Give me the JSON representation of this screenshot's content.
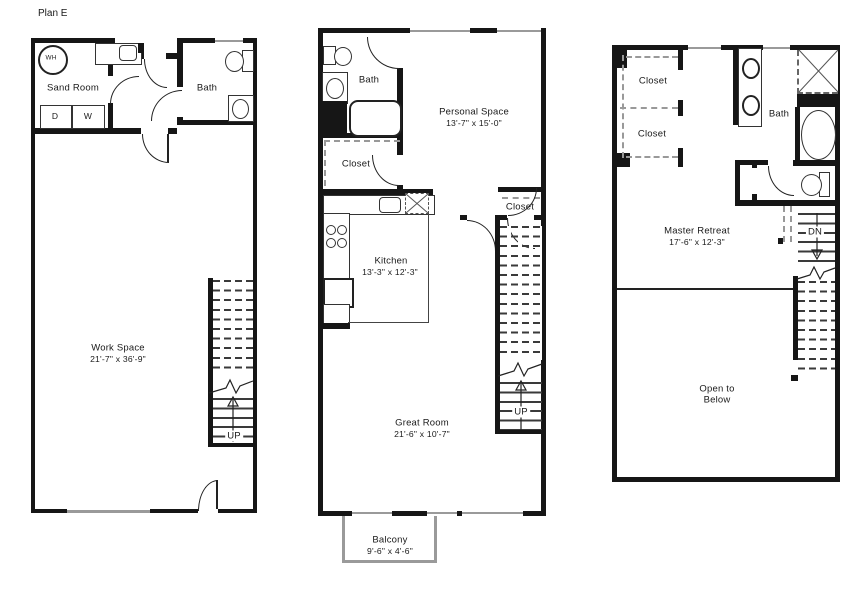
{
  "page_title": "Plan E",
  "colors": {
    "wall": "#161616",
    "dash": "#999999",
    "text": "#1a1a1a",
    "window": "#9a9a9a"
  },
  "floor1": {
    "water_heater": "WH",
    "sand_room": "Sand Room",
    "dryer": "D",
    "washer": "W",
    "bath": "Bath",
    "work_space": "Work Space",
    "work_space_dims": "21'-7\" x 36'-9\"",
    "up": "UP"
  },
  "floor2": {
    "bath": "Bath",
    "personal_space": "Personal Space",
    "personal_space_dims": "13'-7\" x 15'-0\"",
    "closet_a": "Closet",
    "closet_b": "Closet",
    "kitchen": "Kitchen",
    "kitchen_dims": "13'-3\" x 12'-3\"",
    "great_room": "Great Room",
    "great_room_dims": "21'-6\" x 10'-7\"",
    "up": "UP",
    "balcony": "Balcony",
    "balcony_dims": "9'-6\" x 4'-6\""
  },
  "floor3": {
    "closet_a": "Closet",
    "closet_b": "Closet",
    "bath": "Bath",
    "master_retreat": "Master Retreat",
    "master_retreat_dims": "17'-6\" x 12'-3\"",
    "dn": "DN",
    "open_line1": "Open to",
    "open_line2": "Below"
  }
}
